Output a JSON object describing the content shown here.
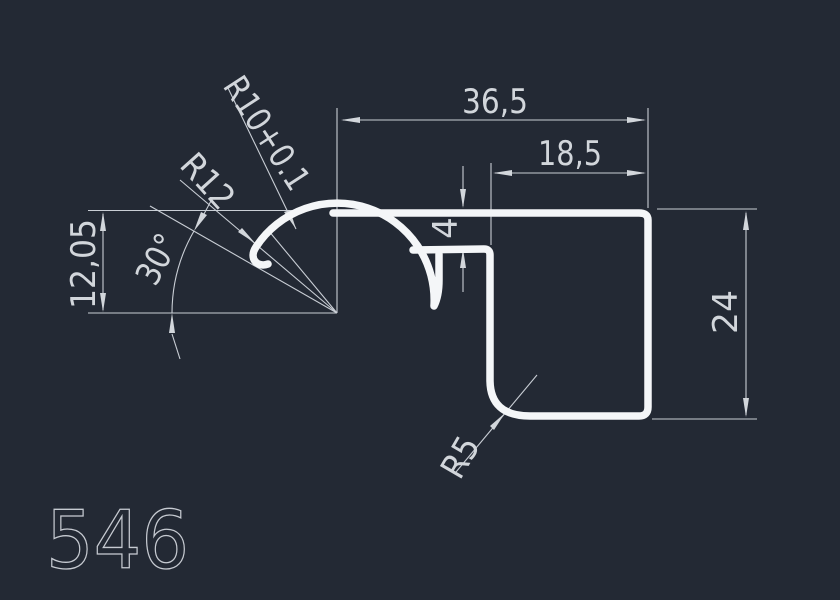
{
  "drawing": {
    "part_number": "546",
    "dims": {
      "total_width": "36,5",
      "body_width": "18,5",
      "step_height": "4",
      "body_height": "24",
      "hook_height": "12,05",
      "hook_angle": "30°",
      "hook_radius": "R10+0.1",
      "tip_radius": "R12",
      "corner_radius": "R5"
    },
    "colors": {
      "background": "#232934",
      "profile_line": "#f4f6f8",
      "dimension_line": "#c9ced5",
      "text": "#d2d6db"
    }
  }
}
